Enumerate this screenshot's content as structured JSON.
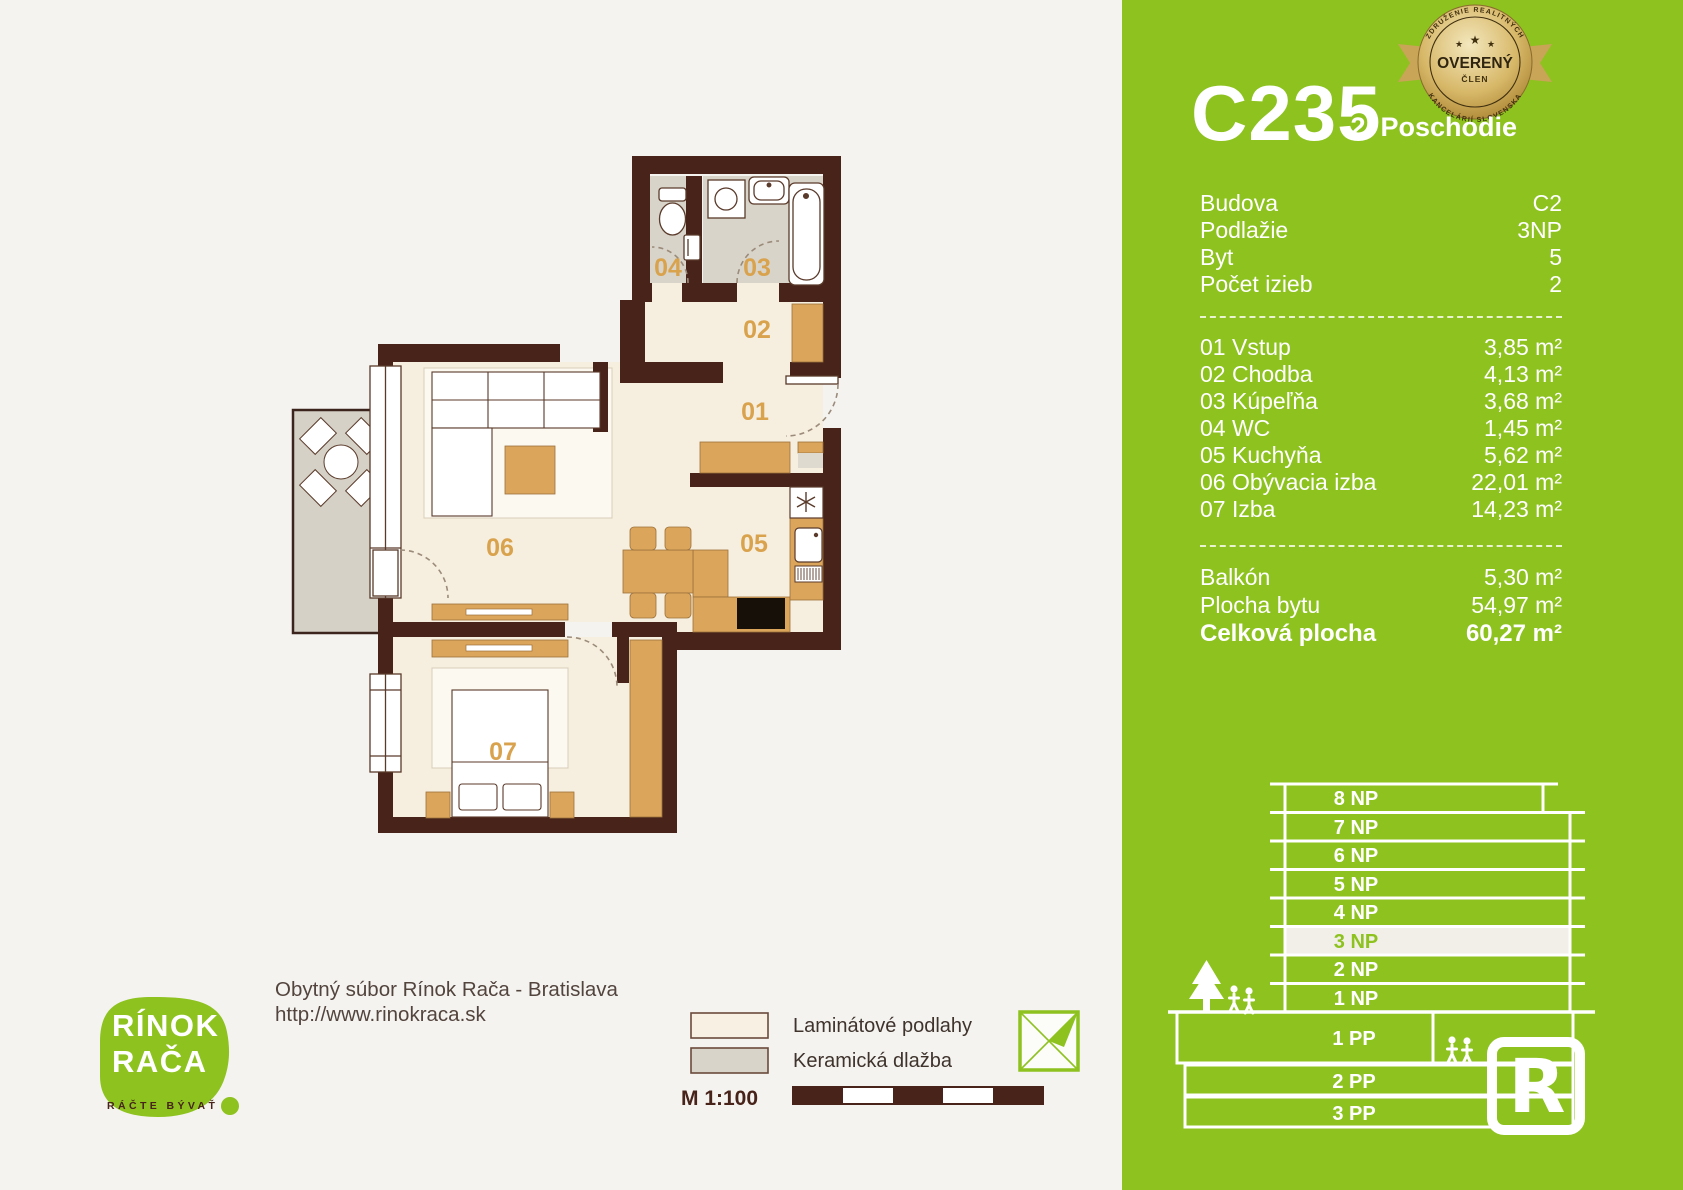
{
  "panel": {
    "unit_code": "C235",
    "floor_label": "2. Poschodie",
    "badge": {
      "top_arc": "ZDRUŽENIE REALITNÝCH",
      "bottom_arc": "KANCELÁRIÍ SLOVENSKA",
      "line1": "OVERENÝ",
      "line2": "ČLEN"
    },
    "info": [
      {
        "label": "Budova",
        "value": "C2"
      },
      {
        "label": "Podlažie",
        "value": "3NP"
      },
      {
        "label": "Byt",
        "value": "5"
      },
      {
        "label": "Počet izieb",
        "value": "2"
      }
    ],
    "rooms": [
      {
        "label": "01 Vstup",
        "value": "3,85 m²"
      },
      {
        "label": "02 Chodba",
        "value": "4,13 m²"
      },
      {
        "label": "03 Kúpeľňa",
        "value": "3,68 m²"
      },
      {
        "label": "04 WC",
        "value": "1,45 m²"
      },
      {
        "label": "05 Kuchyňa",
        "value": "5,62 m²"
      },
      {
        "label": "06 Obývacia izba",
        "value": "22,01 m²"
      },
      {
        "label": "07 Izba",
        "value": "14,23 m²"
      }
    ],
    "totals": [
      {
        "label": "Balkón",
        "value": "5,30 m²"
      },
      {
        "label": "Plocha bytu",
        "value": "54,97 m²"
      },
      {
        "label": "Celková plocha",
        "value": "60,27 m²"
      }
    ],
    "building": {
      "np": [
        "8 NP",
        "7 NP",
        "6 NP",
        "5 NP",
        "4 NP",
        "3 NP",
        "2 NP",
        "1 NP"
      ],
      "highlighted": "3 NP",
      "pp": [
        "1 PP",
        "2 PP",
        "3 PP"
      ]
    }
  },
  "plan": {
    "labels": {
      "r01": "01",
      "r02": "02",
      "r03": "03",
      "r04": "04",
      "r05": "05",
      "r06": "06",
      "r07": "07"
    }
  },
  "footer": {
    "project": "Obytný súbor Rínok Rača - Bratislava",
    "url": "http://www.rinokraca.sk",
    "legend": [
      {
        "label": "Laminátové podlahy"
      },
      {
        "label": "Keramická dlažba"
      }
    ],
    "scale": "M 1:100"
  },
  "logo": {
    "line1": "RÍNOK",
    "line2": "RAČA",
    "tagline": "RÁČTE BÝVAŤ"
  },
  "colors": {
    "green": "#8dc21f",
    "wall_brown": "#47231a",
    "furniture_tan": "#dca55c",
    "label_tan": "#d9a24d",
    "tile_gray": "#d8d4ca",
    "laminate_cream": "#f6eede",
    "badge_gold": "#c9a557"
  }
}
